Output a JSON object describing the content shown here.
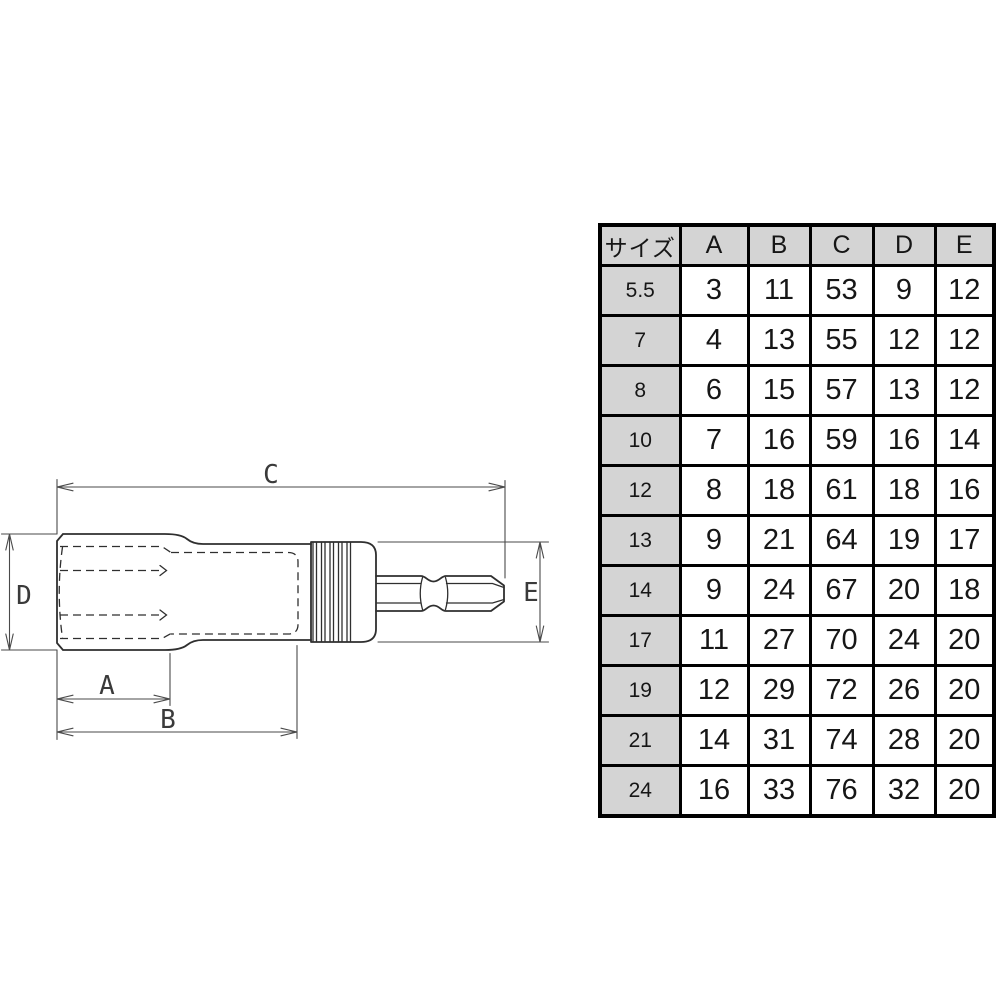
{
  "diagram": {
    "description": "side view technical drawing of socket bit adapter",
    "dimension_labels": {
      "A": "A",
      "B": "B",
      "C": "C",
      "D": "D",
      "E": "E"
    }
  },
  "table": {
    "header": [
      "サイズ",
      "A",
      "B",
      "C",
      "D",
      "E"
    ],
    "rows": [
      {
        "size": "5.5",
        "values": [
          "3",
          "11",
          "53",
          "9",
          "12"
        ]
      },
      {
        "size": "7",
        "values": [
          "4",
          "13",
          "55",
          "12",
          "12"
        ]
      },
      {
        "size": "8",
        "values": [
          "6",
          "15",
          "57",
          "13",
          "12"
        ]
      },
      {
        "size": "10",
        "values": [
          "7",
          "16",
          "59",
          "16",
          "14"
        ]
      },
      {
        "size": "12",
        "values": [
          "8",
          "18",
          "61",
          "18",
          "16"
        ]
      },
      {
        "size": "13",
        "values": [
          "9",
          "21",
          "64",
          "19",
          "17"
        ]
      },
      {
        "size": "14",
        "values": [
          "9",
          "24",
          "67",
          "20",
          "18"
        ]
      },
      {
        "size": "17",
        "values": [
          "11",
          "27",
          "70",
          "24",
          "20"
        ]
      },
      {
        "size": "19",
        "values": [
          "12",
          "29",
          "72",
          "26",
          "20"
        ]
      },
      {
        "size": "21",
        "values": [
          "14",
          "31",
          "74",
          "28",
          "20"
        ]
      },
      {
        "size": "24",
        "values": [
          "16",
          "33",
          "76",
          "32",
          "20"
        ]
      }
    ]
  },
  "colors": {
    "background": "#ffffff",
    "table_header_bg": "#d4d4d4",
    "table_border": "#000000",
    "drawing_line": "#2f2f2f",
    "dimension_line": "#4a4a4a"
  }
}
